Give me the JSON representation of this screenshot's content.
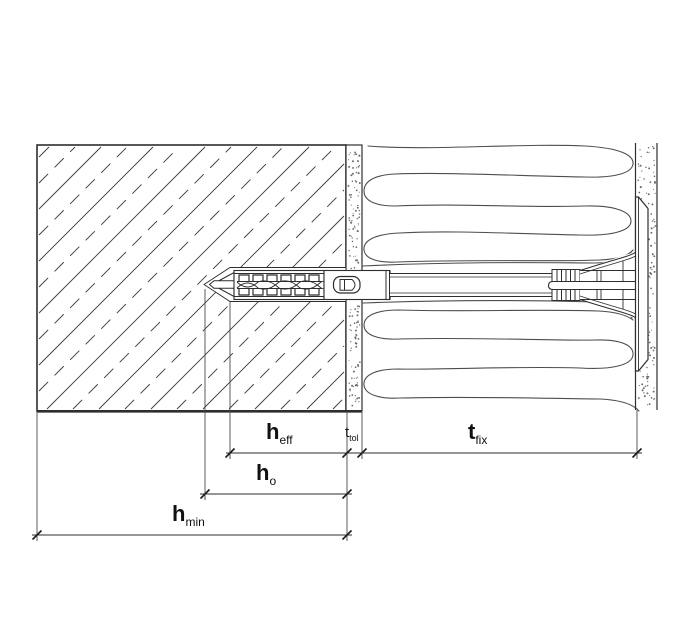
{
  "figure": {
    "type": "technical-drawing",
    "description": "Cross-section of an insulation fixing anchor (dowel with plate) set through insulation into a substrate wall, with anchorage-depth dimensioning",
    "background": "#ffffff"
  },
  "colors": {
    "line": "#2e2e2e",
    "hatch": "#3a3a3a",
    "thin": "#4a4a4a",
    "insulation": "#4d4d4d",
    "stipple": "#6a6a6a",
    "text": "#111111"
  },
  "dim_labels": {
    "h_eff": {
      "main": "h",
      "sub": "eff"
    },
    "t_tol": {
      "main": "t",
      "sub": "tol"
    },
    "t_fix": {
      "main": "t",
      "sub": "fix"
    },
    "h_o": {
      "main": "h",
      "sub": "o"
    },
    "h_min": {
      "main": "h",
      "sub": "min"
    }
  }
}
